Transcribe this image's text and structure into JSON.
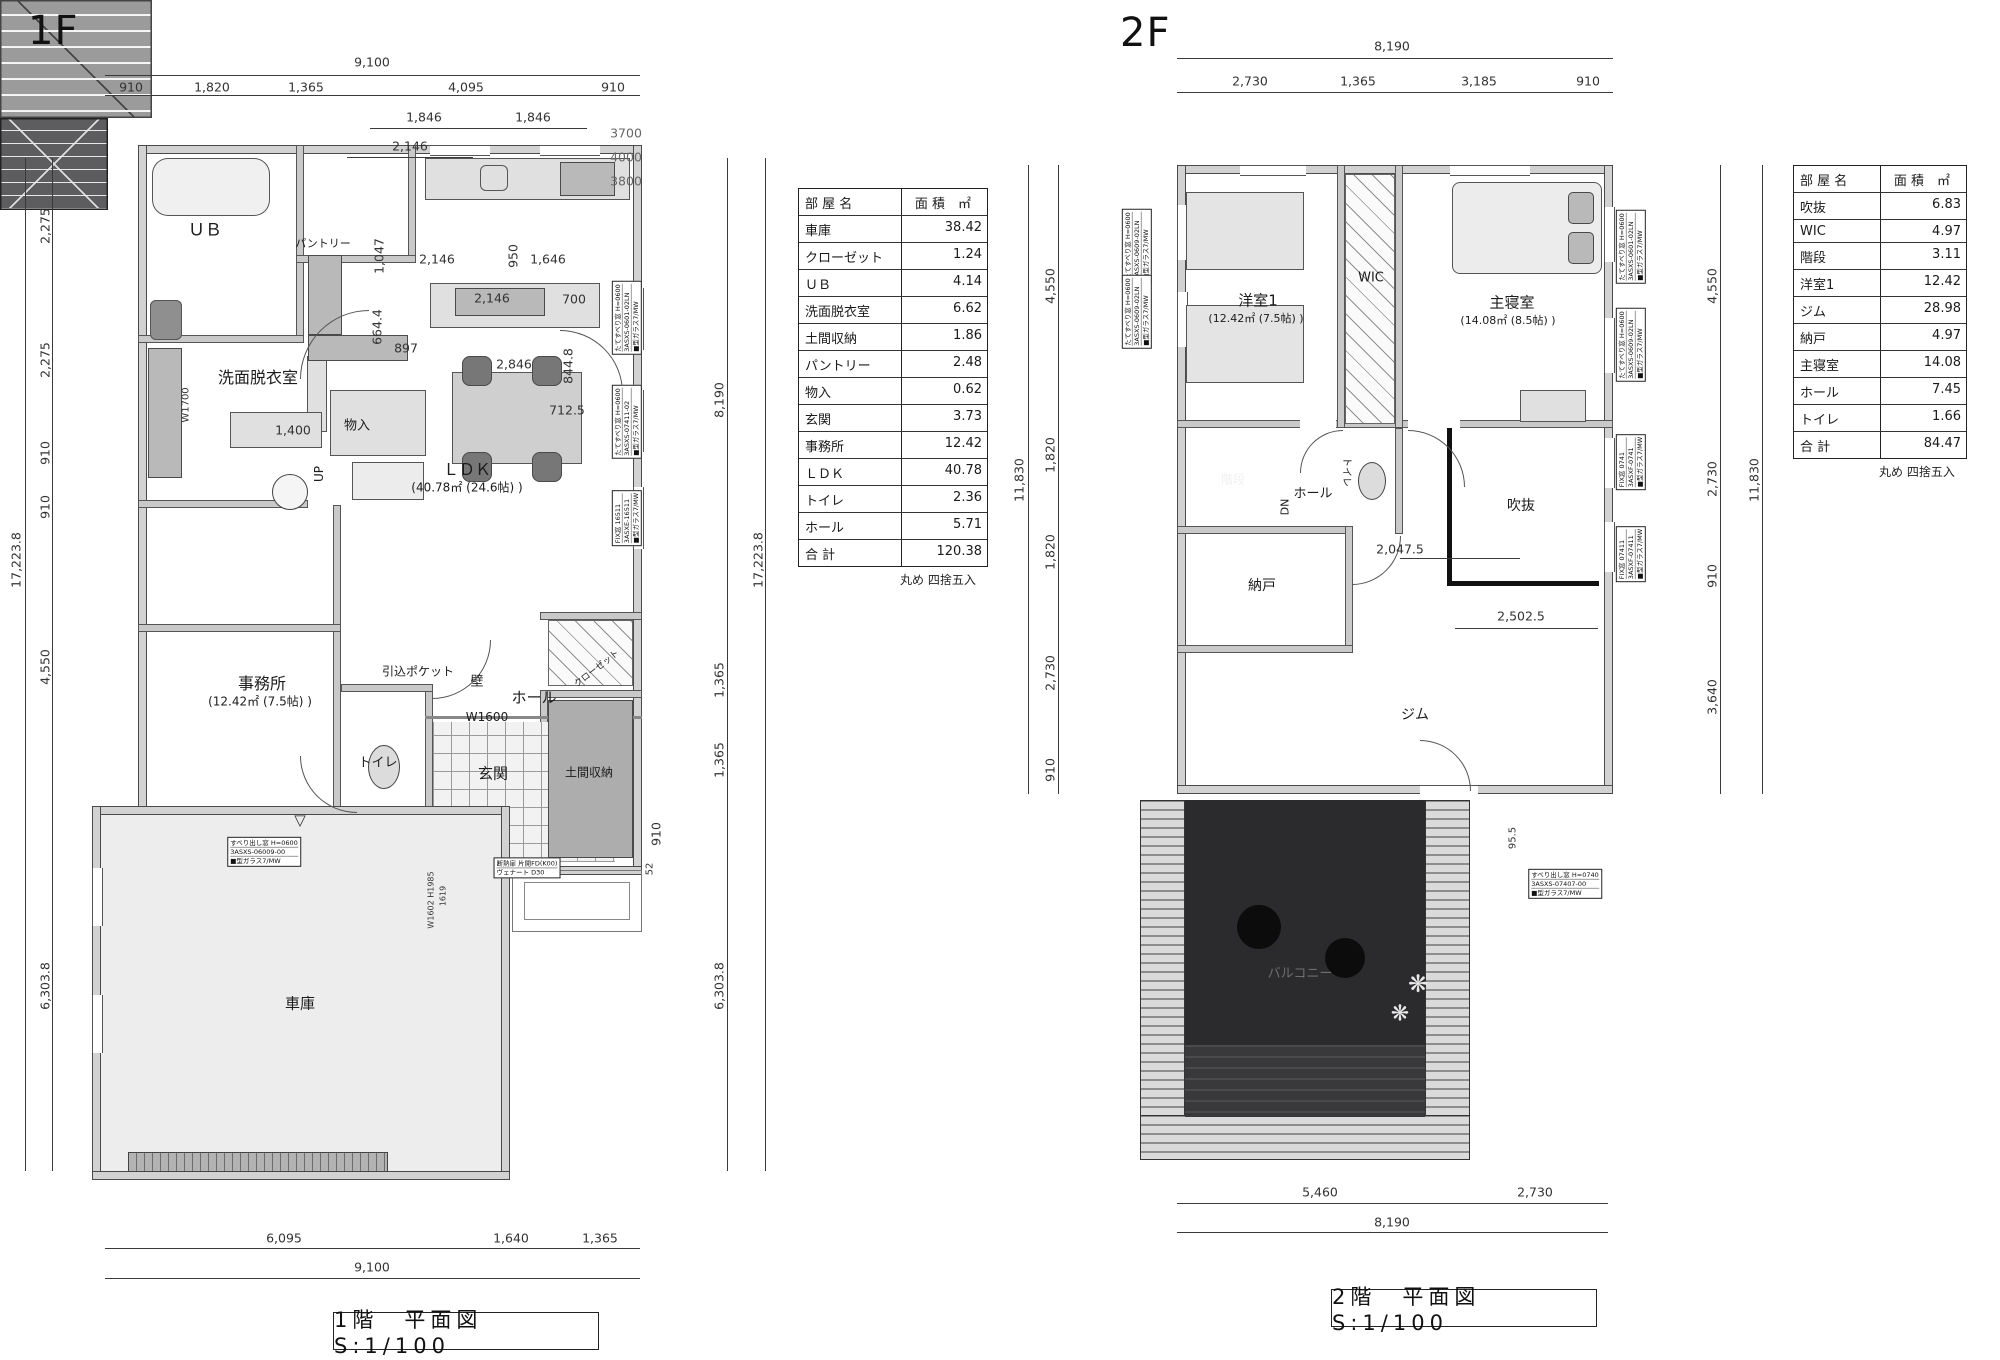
{
  "floor1": {
    "heading": "1F",
    "title": "1階　平面図　S:1/100",
    "table": {
      "x": 798,
      "y": 188,
      "w": 188,
      "name_w": 92,
      "header": [
        "部 屋 名",
        "面 積　㎡"
      ],
      "rows": [
        [
          "車庫",
          "38.42"
        ],
        [
          "クローゼット",
          "1.24"
        ],
        [
          "ＵＢ",
          "4.14"
        ],
        [
          "洗面脱衣室",
          "6.62"
        ],
        [
          "土間収納",
          "1.86"
        ],
        [
          "パントリー",
          "2.48"
        ],
        [
          "物入",
          "0.62"
        ],
        [
          "玄関",
          "3.73"
        ],
        [
          "事務所",
          "12.42"
        ],
        [
          "ＬＤＫ",
          "40.78"
        ],
        [
          "トイレ",
          "2.36"
        ],
        [
          "ホール",
          "5.71"
        ],
        [
          "合 計",
          "120.38"
        ]
      ],
      "note": "丸め 四捨五入"
    },
    "labels": [
      {
        "t": "ＵＢ",
        "x": 205,
        "y": 228,
        "s": 17
      },
      {
        "t": "パントリー",
        "x": 323,
        "y": 243,
        "s": 11
      },
      {
        "t": "洗面脱衣室",
        "x": 258,
        "y": 376,
        "s": 16
      },
      {
        "t": "物入",
        "x": 357,
        "y": 424,
        "s": 13
      },
      {
        "t": "ＬＤＫ",
        "x": 467,
        "y": 468,
        "s": 16
      },
      {
        "t": "(40.78㎡ (24.6帖) )",
        "x": 467,
        "y": 487,
        "s": 12
      },
      {
        "t": "事務所",
        "x": 262,
        "y": 682,
        "s": 16
      },
      {
        "t": "(12.42㎡ (7.5帖) )",
        "x": 260,
        "y": 701,
        "s": 12
      },
      {
        "t": "引込ポケット",
        "x": 418,
        "y": 671,
        "s": 12
      },
      {
        "t": "壁",
        "x": 477,
        "y": 680,
        "s": 13
      },
      {
        "t": "ホール",
        "x": 534,
        "y": 697,
        "s": 15
      },
      {
        "t": "W1600",
        "x": 487,
        "y": 717,
        "s": 12
      },
      {
        "t": "トイレ",
        "x": 378,
        "y": 761,
        "s": 13
      },
      {
        "t": "玄関",
        "x": 493,
        "y": 773,
        "s": 15
      },
      {
        "t": "土間収納",
        "x": 589,
        "y": 772,
        "s": 12
      },
      {
        "t": "クローゼット",
        "x": 596,
        "y": 668,
        "s": 9,
        "r": -38
      },
      {
        "t": "UP",
        "x": 319,
        "y": 474,
        "s": 12,
        "r": -90
      },
      {
        "t": "車庫",
        "x": 300,
        "y": 1003,
        "s": 15
      }
    ],
    "dims": [
      {
        "t": "9,100",
        "x": 372,
        "y": 62
      },
      {
        "t": "910",
        "x": 131,
        "y": 87
      },
      {
        "t": "1,820",
        "x": 212,
        "y": 87
      },
      {
        "t": "1,365",
        "x": 306,
        "y": 87
      },
      {
        "t": "4,095",
        "x": 466,
        "y": 87
      },
      {
        "t": "910",
        "x": 613,
        "y": 87
      },
      {
        "t": "1,846",
        "x": 424,
        "y": 117
      },
      {
        "t": "1,846",
        "x": 533,
        "y": 117
      },
      {
        "t": "2,146",
        "x": 410,
        "y": 146
      },
      {
        "t": "3700",
        "x": 626,
        "y": 133,
        "c": "#666"
      },
      {
        "t": "4000",
        "x": 626,
        "y": 157,
        "c": "#666"
      },
      {
        "t": "3800",
        "x": 626,
        "y": 181,
        "c": "#666"
      },
      {
        "t": "2,146",
        "x": 437,
        "y": 259
      },
      {
        "t": "950",
        "x": 513,
        "y": 256,
        "r": -90
      },
      {
        "t": "1,646",
        "x": 548,
        "y": 259
      },
      {
        "t": "1,047",
        "x": 379,
        "y": 256,
        "r": -90
      },
      {
        "t": "664.4",
        "x": 377,
        "y": 327,
        "r": -90
      },
      {
        "t": "2,146",
        "x": 492,
        "y": 298
      },
      {
        "t": "700",
        "x": 574,
        "y": 299
      },
      {
        "t": "897",
        "x": 406,
        "y": 348
      },
      {
        "t": "2,846",
        "x": 514,
        "y": 364
      },
      {
        "t": "844.8",
        "x": 568,
        "y": 366,
        "r": -90
      },
      {
        "t": "712.5",
        "x": 567,
        "y": 410
      },
      {
        "t": "1,400",
        "x": 293,
        "y": 430
      },
      {
        "t": "W1700",
        "x": 186,
        "y": 405,
        "r": -90,
        "s": 10
      },
      {
        "t": "910",
        "x": 656,
        "y": 834,
        "r": -90
      },
      {
        "t": "52",
        "x": 650,
        "y": 869,
        "r": -90,
        "s": 10
      },
      {
        "t": "W1602 H1985",
        "x": 431,
        "y": 900,
        "r": -90,
        "s": 8
      },
      {
        "t": "1619",
        "x": 443,
        "y": 896,
        "r": -90,
        "s": 8
      },
      {
        "t": "17,223.8",
        "x": 16,
        "y": 560,
        "r": -90
      },
      {
        "t": "2,275",
        "x": 45,
        "y": 226,
        "r": -90
      },
      {
        "t": "2,275",
        "x": 45,
        "y": 360,
        "r": -90
      },
      {
        "t": "910",
        "x": 45,
        "y": 453,
        "r": -90
      },
      {
        "t": "910",
        "x": 45,
        "y": 507,
        "r": -90
      },
      {
        "t": "4,550",
        "x": 45,
        "y": 667,
        "r": -90
      },
      {
        "t": "6,303.8",
        "x": 45,
        "y": 986,
        "r": -90
      },
      {
        "t": "8,190",
        "x": 719,
        "y": 400,
        "r": -90
      },
      {
        "t": "1,365",
        "x": 719,
        "y": 680,
        "r": -90
      },
      {
        "t": "1,365",
        "x": 719,
        "y": 760,
        "r": -90
      },
      {
        "t": "6,303.8",
        "x": 719,
        "y": 986,
        "r": -90
      },
      {
        "t": "17,223.8",
        "x": 758,
        "y": 560,
        "r": -90
      },
      {
        "t": "6,095",
        "x": 284,
        "y": 1238
      },
      {
        "t": "1,640",
        "x": 511,
        "y": 1238
      },
      {
        "t": "1,365",
        "x": 600,
        "y": 1238
      },
      {
        "t": "9,100",
        "x": 372,
        "y": 1267
      }
    ],
    "dim_lines": [
      {
        "x": 105,
        "y": 75,
        "w": 535,
        "h": 1
      },
      {
        "x": 105,
        "y": 95,
        "w": 535,
        "h": 1
      },
      {
        "x": 370,
        "y": 128,
        "w": 217,
        "h": 1
      },
      {
        "x": 347,
        "y": 157,
        "w": 126,
        "h": 1
      },
      {
        "x": 25,
        "y": 158,
        "w": 1,
        "h": 1013
      },
      {
        "x": 52,
        "y": 158,
        "w": 1,
        "h": 1013
      },
      {
        "x": 727,
        "y": 158,
        "w": 1,
        "h": 1013
      },
      {
        "x": 765,
        "y": 158,
        "w": 1,
        "h": 1013
      },
      {
        "x": 105,
        "y": 1248,
        "w": 535,
        "h": 1
      },
      {
        "x": 105,
        "y": 1278,
        "w": 535,
        "h": 1
      }
    ],
    "tags": [
      {
        "x": 627,
        "y": 318,
        "r": -90,
        "lines": [
          "たてすべり窓 H=0600",
          "3ASXS-0601-02LN",
          "■型ガラス7/MW"
        ]
      },
      {
        "x": 627,
        "y": 422,
        "r": -90,
        "lines": [
          "たてすべり窓 H=0600",
          "3ASXS-07411-02",
          "■型ガラス7/MW"
        ]
      },
      {
        "x": 627,
        "y": 518,
        "r": -90,
        "lines": [
          "FIX窓 16511",
          "3ASXE-16511",
          "■型ガラス7/MW"
        ]
      },
      {
        "x": 264,
        "y": 852,
        "r": 0,
        "lines": [
          "すべり出し窓 H=0600",
          "3ASXS-06009-00",
          "■型ガラス7/MW"
        ]
      },
      {
        "x": 527,
        "y": 868,
        "r": 0,
        "lines": [
          "断熱扉 片開FD(K00)",
          "ヴェナート D30"
        ]
      }
    ]
  },
  "floor2": {
    "heading": "2F",
    "title": "2階　平面図　S:1/100",
    "table": {
      "x": 1793,
      "y": 165,
      "w": 172,
      "name_w": 76,
      "header": [
        "部 屋 名",
        "面 積　㎡"
      ],
      "rows": [
        [
          "吹抜",
          "6.83"
        ],
        [
          "WIC",
          "4.97"
        ],
        [
          "階段",
          "3.11"
        ],
        [
          "洋室1",
          "12.42"
        ],
        [
          "ジム",
          "28.98"
        ],
        [
          "納戸",
          "4.97"
        ],
        [
          "主寝室",
          "14.08"
        ],
        [
          "ホール",
          "7.45"
        ],
        [
          "トイレ",
          "1.66"
        ],
        [
          "合 計",
          "84.47"
        ]
      ],
      "note": "丸め 四捨五入"
    },
    "labels": [
      {
        "t": "洋室1",
        "x": 1258,
        "y": 300,
        "s": 15
      },
      {
        "t": "(12.42㎡ (7.5帖) )",
        "x": 1256,
        "y": 318,
        "s": 11
      },
      {
        "t": "WIC",
        "x": 1371,
        "y": 278,
        "s": 13
      },
      {
        "t": "主寝室",
        "x": 1512,
        "y": 302,
        "s": 15
      },
      {
        "t": "(14.08㎡ (8.5帖) )",
        "x": 1508,
        "y": 320,
        "s": 11
      },
      {
        "t": "階段",
        "x": 1233,
        "y": 479,
        "s": 12,
        "c": "#f0f0f0"
      },
      {
        "t": "ホール",
        "x": 1313,
        "y": 492,
        "s": 13
      },
      {
        "t": "DN",
        "x": 1285,
        "y": 507,
        "s": 11,
        "r": -90
      },
      {
        "t": "トイレ",
        "x": 1348,
        "y": 472,
        "s": 10,
        "r": 90
      },
      {
        "t": "納戸",
        "x": 1262,
        "y": 585,
        "s": 14
      },
      {
        "t": "吹抜",
        "x": 1521,
        "y": 505,
        "s": 14
      },
      {
        "t": "ジム",
        "x": 1415,
        "y": 714,
        "s": 14
      },
      {
        "t": "バルコニー",
        "x": 1300,
        "y": 972,
        "s": 13,
        "c": "#6e6e6e"
      }
    ],
    "dims": [
      {
        "t": "8,190",
        "x": 1392,
        "y": 46
      },
      {
        "t": "2,730",
        "x": 1250,
        "y": 81
      },
      {
        "t": "1,365",
        "x": 1358,
        "y": 81
      },
      {
        "t": "3,185",
        "x": 1479,
        "y": 81
      },
      {
        "t": "910",
        "x": 1588,
        "y": 81
      },
      {
        "t": "11,830",
        "x": 1019,
        "y": 480,
        "r": -90
      },
      {
        "t": "4,550",
        "x": 1050,
        "y": 286,
        "r": -90
      },
      {
        "t": "1,820",
        "x": 1050,
        "y": 455,
        "r": -90
      },
      {
        "t": "1,820",
        "x": 1050,
        "y": 552,
        "r": -90
      },
      {
        "t": "2,730",
        "x": 1050,
        "y": 673,
        "r": -90
      },
      {
        "t": "910",
        "x": 1050,
        "y": 770,
        "r": -90
      },
      {
        "t": "4,550",
        "x": 1712,
        "y": 286,
        "r": -90
      },
      {
        "t": "2,730",
        "x": 1712,
        "y": 479,
        "r": -90
      },
      {
        "t": "910",
        "x": 1712,
        "y": 576,
        "r": -90
      },
      {
        "t": "3,640",
        "x": 1712,
        "y": 697,
        "r": -90
      },
      {
        "t": "11,830",
        "x": 1754,
        "y": 480,
        "r": -90
      },
      {
        "t": "2,047.5",
        "x": 1400,
        "y": 549
      },
      {
        "t": "2,502.5",
        "x": 1521,
        "y": 616
      },
      {
        "t": "95.5",
        "x": 1513,
        "y": 838,
        "r": -90,
        "s": 10
      },
      {
        "t": "5,460",
        "x": 1320,
        "y": 1192
      },
      {
        "t": "2,730",
        "x": 1535,
        "y": 1192
      },
      {
        "t": "8,190",
        "x": 1392,
        "y": 1222
      }
    ],
    "dim_lines": [
      {
        "x": 1177,
        "y": 58,
        "w": 436,
        "h": 1
      },
      {
        "x": 1177,
        "y": 92,
        "w": 436,
        "h": 1
      },
      {
        "x": 1028,
        "y": 165,
        "w": 1,
        "h": 629
      },
      {
        "x": 1058,
        "y": 165,
        "w": 1,
        "h": 629
      },
      {
        "x": 1720,
        "y": 165,
        "w": 1,
        "h": 629
      },
      {
        "x": 1762,
        "y": 165,
        "w": 1,
        "h": 629
      },
      {
        "x": 1177,
        "y": 1203,
        "w": 431,
        "h": 1
      },
      {
        "x": 1177,
        "y": 1232,
        "w": 431,
        "h": 1
      },
      {
        "x": 1400,
        "y": 558,
        "w": 120,
        "h": 1
      },
      {
        "x": 1455,
        "y": 628,
        "w": 143,
        "h": 1
      }
    ],
    "tags": [
      {
        "x": 1137,
        "y": 246,
        "r": -90,
        "lines": [
          "たてすべり窓 H=0600",
          "3ASXS-0609-02LN",
          "■型ガラス7/MW"
        ]
      },
      {
        "x": 1137,
        "y": 312,
        "r": -90,
        "lines": [
          "たてすべり窓 H=0600",
          "3ASXS-0609-02LN",
          "■型ガラス7/MW"
        ]
      },
      {
        "x": 1631,
        "y": 247,
        "r": -90,
        "lines": [
          "たてすべり窓 H=0600",
          "3ASXS-0601-02LN",
          "■型ガラス7/MW"
        ]
      },
      {
        "x": 1631,
        "y": 345,
        "r": -90,
        "lines": [
          "たてすべり窓 H=0600",
          "3ASXS-0609-02LN",
          "■型ガラス7/MW"
        ]
      },
      {
        "x": 1631,
        "y": 462,
        "r": -90,
        "lines": [
          "FIX窓 0741",
          "3ASXF-0741",
          "■型ガラス7/MW"
        ]
      },
      {
        "x": 1631,
        "y": 554,
        "r": -90,
        "lines": [
          "FIX窓 07411",
          "3ASXF-07411",
          "■型ガラス7/MW"
        ]
      },
      {
        "x": 1565,
        "y": 884,
        "r": 0,
        "lines": [
          "すべり出し窓 H=0740",
          "3ASXS-07407-00",
          "■型ガラス7/MW"
        ]
      }
    ]
  }
}
